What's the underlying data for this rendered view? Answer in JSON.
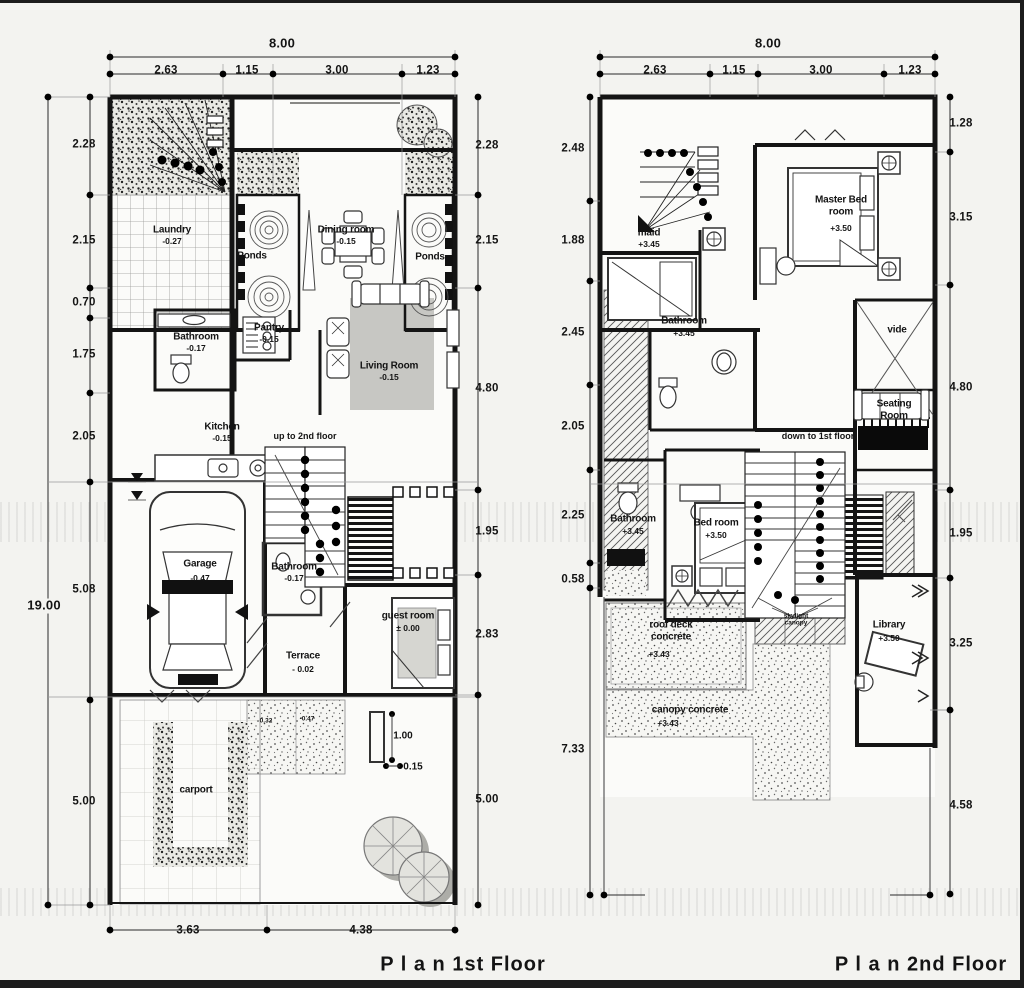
{
  "document": {
    "type": "architectural floor plan drawing",
    "paper_color": "#f3f3f0",
    "ink_color": "#141414"
  },
  "floor1": {
    "title": "P l a n   1st Floor",
    "dimensions": {
      "top": [
        "8.00",
        "2.63",
        "1.15",
        "3.00",
        "1.23"
      ],
      "left_overall": "19.00",
      "left": [
        "2.28",
        "2.15",
        "0.70",
        "1.75",
        "2.05",
        "5.08",
        "5.00"
      ],
      "right": [
        "2.28",
        "2.15",
        "4.80",
        "1.95",
        "2.83",
        "5.00"
      ],
      "bottom": [
        "3.63",
        "4.38"
      ],
      "inner": [
        "1.00",
        "0.15"
      ]
    },
    "rooms": [
      {
        "name": "Laundry",
        "level": "-0.27"
      },
      {
        "name": "Ponds",
        "level": ""
      },
      {
        "name": "Dining room",
        "level": "-0.15"
      },
      {
        "name": "Ponds",
        "level": ""
      },
      {
        "name": "Bathroom",
        "level": "-0.17"
      },
      {
        "name": "Pantry",
        "level": "-0.15"
      },
      {
        "name": "Living Room",
        "level": "-0.15"
      },
      {
        "name": "Kitchen",
        "level": "-0.15"
      },
      {
        "name": "Garage",
        "level": "-0.47"
      },
      {
        "name": "Bathroom",
        "level": "-0.17"
      },
      {
        "name": "guest room",
        "level": "± 0.00"
      },
      {
        "name": "Terrace",
        "level": "- 0.02"
      },
      {
        "name": "carport",
        "level": ""
      }
    ],
    "annotations": [
      "up to 2nd floor",
      "0.32",
      "-0.47"
    ]
  },
  "floor2": {
    "title": "P l a n   2nd Floor",
    "dimensions": {
      "top": [
        "8.00",
        "2.63",
        "1.15",
        "3.00",
        "1.23"
      ],
      "left": [
        "2.48",
        "1.88",
        "2.45",
        "2.05",
        "2.25",
        "0.58",
        "7.33"
      ],
      "right": [
        "1.28",
        "3.15",
        "4.80",
        "1.95",
        "3.25",
        "4.58"
      ]
    },
    "rooms": [
      {
        "name": "maid",
        "level": "+3.45"
      },
      {
        "name": "Master Bed room",
        "level": "+3.50"
      },
      {
        "name": "Bathroom",
        "level": "+3.45"
      },
      {
        "name": "vide",
        "level": ""
      },
      {
        "name": "Seating Room",
        "level": ""
      },
      {
        "name": "Bathroom",
        "level": "+3.45"
      },
      {
        "name": "Bed room",
        "level": "+3.50"
      },
      {
        "name": "roof deck concrete",
        "level": "+3.43"
      },
      {
        "name": "canopy concrete",
        "level": "+3.43"
      },
      {
        "name": "Library",
        "level": "+3.50"
      },
      {
        "name": "skylight canopy",
        "level": ""
      }
    ],
    "annotations": [
      "down to 1st floor"
    ]
  }
}
